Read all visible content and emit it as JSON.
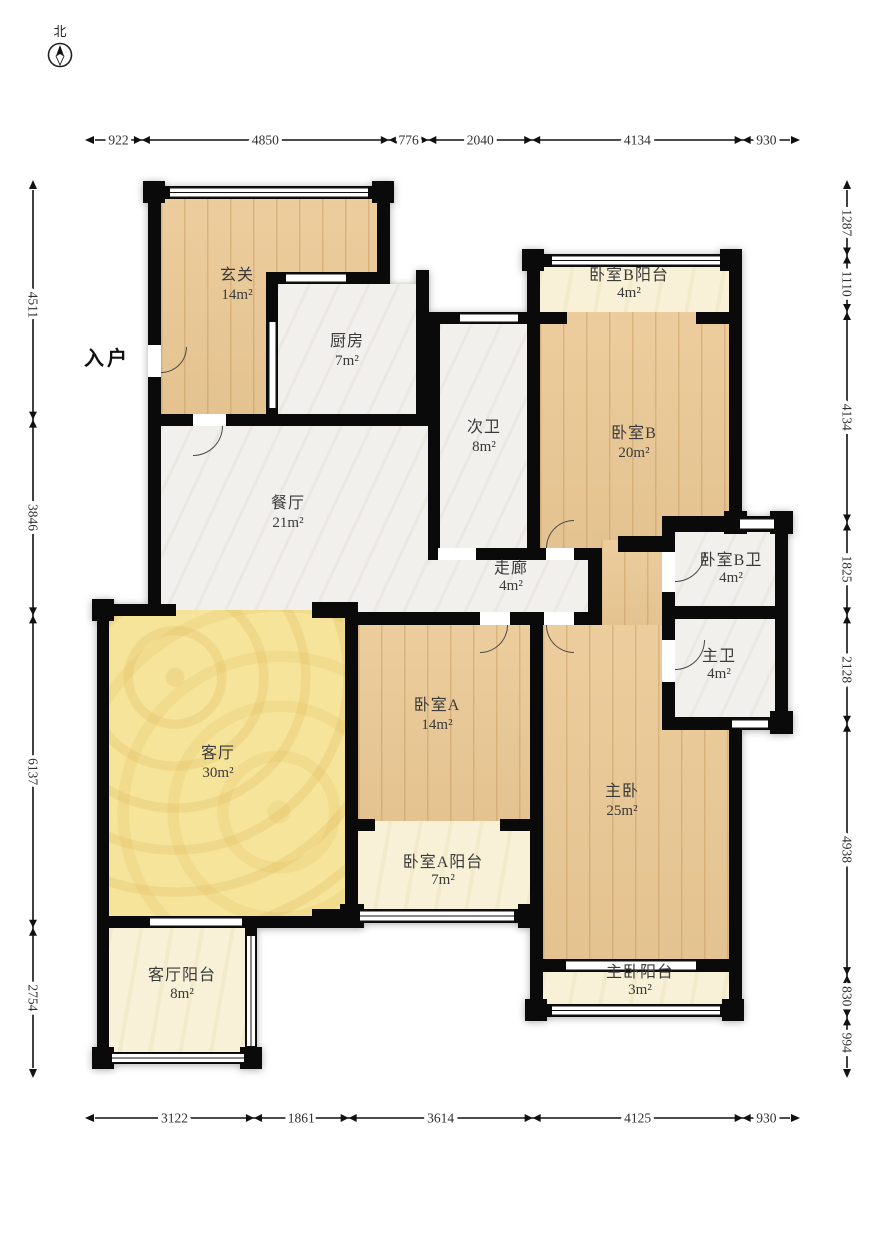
{
  "compass": {
    "north_label": "北"
  },
  "entrance_label": "入户",
  "rooms": {
    "xuanguan": {
      "name": "玄关",
      "area": "14m²"
    },
    "kitchen": {
      "name": "厨房",
      "area": "7m²"
    },
    "ciwei": {
      "name": "次卫",
      "area": "8m²"
    },
    "balcony_b": {
      "name": "卧室B阳台",
      "area": "4m²"
    },
    "bedroom_b": {
      "name": "卧室B",
      "area": "20m²"
    },
    "dining": {
      "name": "餐厅",
      "area": "21m²"
    },
    "corridor": {
      "name": "走廊",
      "area": "4m²"
    },
    "bedroom_b_bath": {
      "name": "卧室B卫",
      "area": "4m²"
    },
    "master_bath": {
      "name": "主卫",
      "area": "4m²"
    },
    "living": {
      "name": "客厅",
      "area": "30m²"
    },
    "bedroom_a": {
      "name": "卧室A",
      "area": "14m²"
    },
    "master": {
      "name": "主卧",
      "area": "25m²"
    },
    "bedroom_a_balcony": {
      "name": "卧室A阳台",
      "area": "7m²"
    },
    "living_balcony": {
      "name": "客厅阳台",
      "area": "8m²"
    },
    "master_balcony": {
      "name": "主卧阳台",
      "area": "3m²"
    }
  },
  "dimensions": {
    "top": [
      922,
      4850,
      776,
      2040,
      4134,
      930
    ],
    "left": [
      4511,
      3846,
      6137,
      2754
    ],
    "right": [
      1287,
      1110,
      4134,
      1825,
      2128,
      4938,
      830,
      994
    ],
    "bottom": [
      3122,
      1861,
      3614,
      4125,
      930
    ]
  },
  "colors": {
    "wall": "#0a0a0a",
    "wood_floor": "#ebc995",
    "marble_floor": "#f2f0ec",
    "living_room_yellow": "#f6e49b",
    "balcony_cream": "#f8f1d7",
    "dimension_text": "#2f2f2f"
  }
}
